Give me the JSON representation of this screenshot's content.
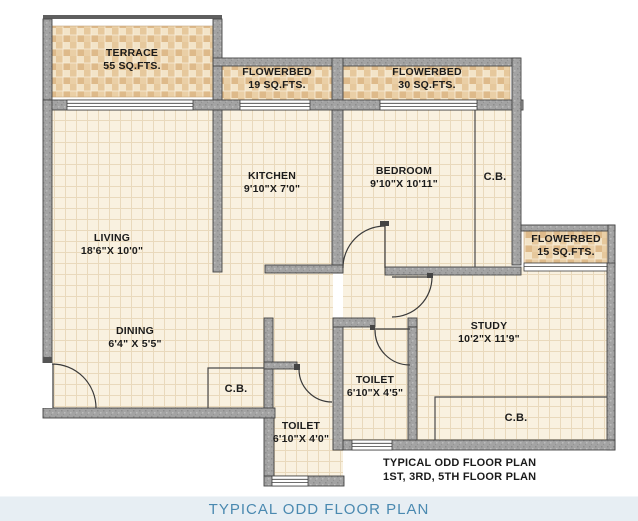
{
  "plan": {
    "rooms": {
      "terrace": {
        "label": "TERRACE",
        "detail": "55 SQ.FTS."
      },
      "flowerbed_19": {
        "label": "FLOWERBED",
        "detail": "19 SQ.FTS."
      },
      "flowerbed_30": {
        "label": "FLOWERBED",
        "detail": "30 SQ.FTS."
      },
      "flowerbed_15": {
        "label": "FLOWERBED",
        "detail": "15 SQ.FTS."
      },
      "kitchen": {
        "label": "KITCHEN",
        "detail": "9'10\"X 7'0\""
      },
      "bedroom": {
        "label": "BEDROOM",
        "detail": "9'10\"X 10'11\""
      },
      "living": {
        "label": "LIVING",
        "detail": "18'6\"X 10'0\""
      },
      "dining": {
        "label": "DINING",
        "detail": "6'4\" X 5'5\""
      },
      "study": {
        "label": "STUDY",
        "detail": "10'2\"X 11'9\""
      },
      "toilet_1": {
        "label": "TOILET",
        "detail": "6'10\"X 4'5\""
      },
      "toilet_2": {
        "label": "TOILET",
        "detail": "6'10\"X 4'0\""
      },
      "cb_bedroom": {
        "label": "C.B."
      },
      "cb_dining": {
        "label": "C.B."
      },
      "cb_study": {
        "label": "C.B."
      }
    },
    "annotation": {
      "line1": "TYPICAL ODD FLOOR PLAN",
      "line2": "1ST, 3RD, 5TH FLOOR PLAN"
    }
  },
  "caption": {
    "text": "TYPICAL ODD FLOOR PLAN"
  },
  "colors": {
    "floor": "#f9f1e0",
    "floor_grid": "#e9d9bc",
    "tile": "#efdab4",
    "wall": "#a3a3a3",
    "wall_edge": "#454545",
    "label_text": "#1b1b1b",
    "caption_text": "#4a89b0",
    "caption_bg": "#e7eef3"
  }
}
